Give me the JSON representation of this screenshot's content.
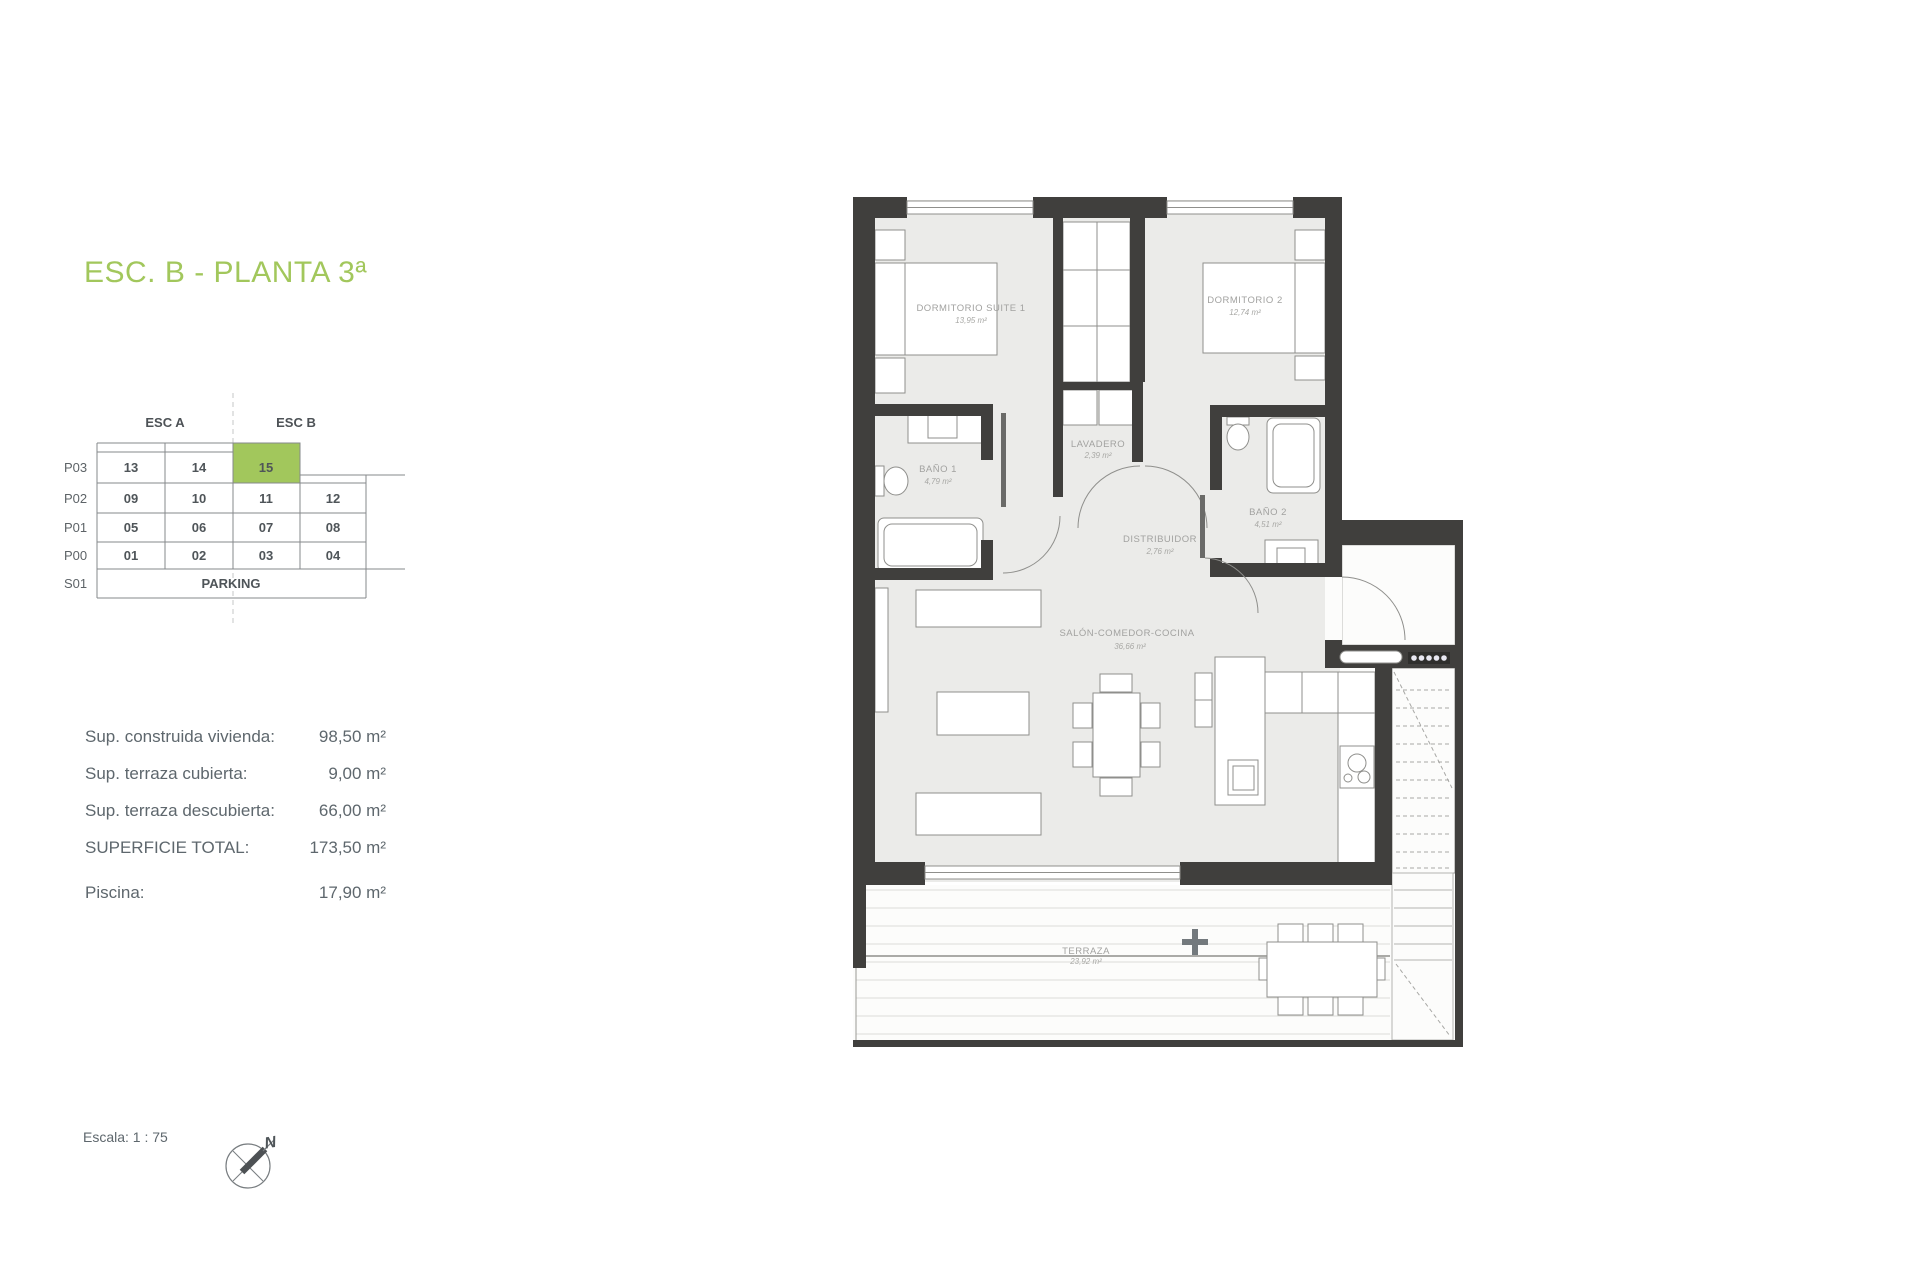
{
  "title": "ESC. B - PLANTA 3ª",
  "colors": {
    "accent_green": "#a2c75c",
    "wall_dark": "#403f3d",
    "floor_gray": "#ebebe9"
  },
  "building_table": {
    "col_headers": [
      "ESC A",
      "ESC B"
    ],
    "row_labels": [
      "P03",
      "P02",
      "P01",
      "P00",
      "S01"
    ],
    "rows": [
      [
        "13",
        "14",
        "15"
      ],
      [
        "09",
        "10",
        "11",
        "12"
      ],
      [
        "05",
        "06",
        "07",
        "08"
      ],
      [
        "01",
        "02",
        "03",
        "04"
      ]
    ],
    "parking_label": "PARKING",
    "highlighted_unit": "15"
  },
  "areas": [
    {
      "label": "Sup. construida vivienda:",
      "value": "98,50 m²"
    },
    {
      "label": "Sup. terraza cubierta:",
      "value": "9,00 m²"
    },
    {
      "label": "Sup. terraza descubierta:",
      "value": "66,00 m²"
    },
    {
      "label": "SUPERFICIE TOTAL:",
      "value": "173,50 m²"
    },
    {
      "label": "Piscina:",
      "value": "17,90 m²"
    }
  ],
  "scale_label": "Escala: 1 : 75",
  "compass_letter": "N",
  "floorplan": {
    "rooms": [
      {
        "name": "DORMITORIO SUITE 1",
        "area": "13,95 m²"
      },
      {
        "name": "DORMITORIO 2",
        "area": "12,74 m²"
      },
      {
        "name": "LAVADERO",
        "area": "2,39 m²"
      },
      {
        "name": "BAÑO 1",
        "area": "4,79 m²"
      },
      {
        "name": "BAÑO 2",
        "area": "4,51 m²"
      },
      {
        "name": "DISTRIBUIDOR",
        "area": "2,76 m²"
      },
      {
        "name": "SALÓN-COMEDOR-COCINA",
        "area": "36,66 m²"
      },
      {
        "name": "TERRAZA",
        "area": "23,92 m²"
      }
    ]
  }
}
